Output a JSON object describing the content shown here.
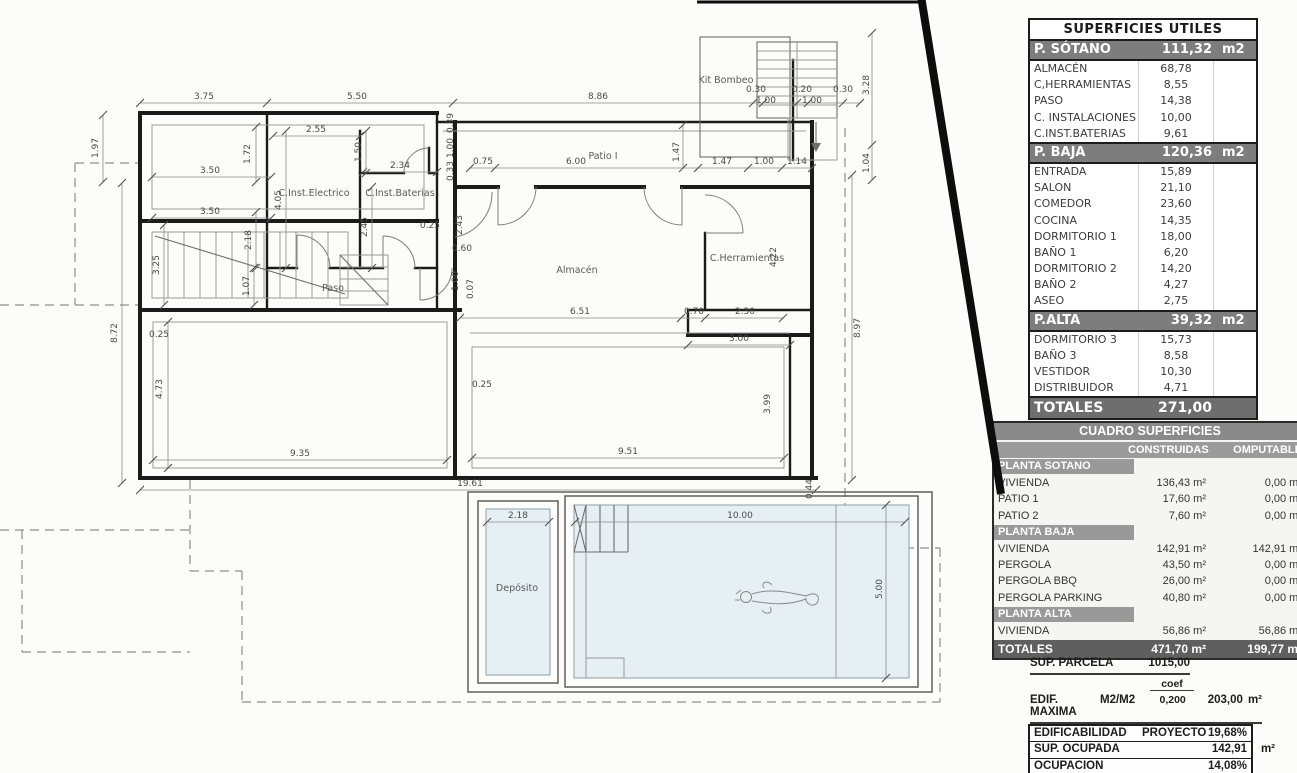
{
  "colors": {
    "table_header_gray": "#7d7d7d",
    "totals_bar_gray": "#6e6e6e",
    "dark_totals": "#5f5f5f",
    "pool_fill": "#e6eff3",
    "wall_black": "#1b1b1b"
  },
  "plan": {
    "room_labels": [
      {
        "t": "Kit Bombeo",
        "x": 726,
        "y": 83
      },
      {
        "t": "C.Inst.Electrico",
        "x": 314,
        "y": 196
      },
      {
        "t": "C.Inst.Baterias",
        "x": 400,
        "y": 196
      },
      {
        "t": "Paso",
        "x": 333,
        "y": 291
      },
      {
        "t": "Patio I",
        "x": 603,
        "y": 159
      },
      {
        "t": "Almacén",
        "x": 577,
        "y": 273
      },
      {
        "t": "C.Herramientas",
        "x": 747,
        "y": 261
      },
      {
        "t": "Depósito",
        "x": 517,
        "y": 591
      }
    ],
    "dim_labels": [
      {
        "t": "3.75",
        "x": 204,
        "y": 99
      },
      {
        "t": "5.50",
        "x": 357,
        "y": 99
      },
      {
        "t": "8.86",
        "x": 598,
        "y": 99
      },
      {
        "t": "0.30",
        "x": 756,
        "y": 92
      },
      {
        "t": "1.00",
        "x": 766,
        "y": 103
      },
      {
        "t": "0.20",
        "x": 802,
        "y": 92
      },
      {
        "t": "1.00",
        "x": 812,
        "y": 103
      },
      {
        "t": "0.30",
        "x": 843,
        "y": 92
      },
      {
        "t": "3.28",
        "x": 869,
        "y": 85,
        "v": 1
      },
      {
        "t": "1.04",
        "x": 869,
        "y": 163,
        "v": 1
      },
      {
        "t": "1.97",
        "x": 98,
        "y": 148,
        "v": 1
      },
      {
        "t": "8.72",
        "x": 117,
        "y": 333,
        "v": 1
      },
      {
        "t": "1.72",
        "x": 250,
        "y": 154,
        "v": 1
      },
      {
        "t": "3.50",
        "x": 210,
        "y": 173
      },
      {
        "t": "2.55",
        "x": 316,
        "y": 132
      },
      {
        "t": "1.50",
        "x": 361,
        "y": 152,
        "v": 1
      },
      {
        "t": "2.34",
        "x": 400,
        "y": 168
      },
      {
        "t": "4.05",
        "x": 281,
        "y": 200,
        "v": 1
      },
      {
        "t": "2.45",
        "x": 367,
        "y": 227,
        "v": 1
      },
      {
        "t": "3.50",
        "x": 210,
        "y": 214
      },
      {
        "t": "3.25",
        "x": 159,
        "y": 265,
        "v": 1
      },
      {
        "t": "2.18",
        "x": 251,
        "y": 240,
        "v": 1
      },
      {
        "t": "0.25",
        "x": 430,
        "y": 228
      },
      {
        "t": "0.39",
        "x": 453,
        "y": 123,
        "v": 1
      },
      {
        "t": "1.00",
        "x": 453,
        "y": 148,
        "v": 1
      },
      {
        "t": "0.33",
        "x": 453,
        "y": 171,
        "v": 1
      },
      {
        "t": "2.43",
        "x": 462,
        "y": 225,
        "v": 1
      },
      {
        "t": "0.60",
        "x": 462,
        "y": 251
      },
      {
        "t": "1.07",
        "x": 249,
        "y": 286,
        "v": 1
      },
      {
        "t": "1.00",
        "x": 458,
        "y": 281,
        "v": 1
      },
      {
        "t": "0.07",
        "x": 473,
        "y": 289,
        "v": 1
      },
      {
        "t": "0.75",
        "x": 483,
        "y": 164
      },
      {
        "t": "6.00",
        "x": 576,
        "y": 164
      },
      {
        "t": "1.47",
        "x": 679,
        "y": 152,
        "v": 1
      },
      {
        "t": "1.47",
        "x": 722,
        "y": 164
      },
      {
        "t": "1.00",
        "x": 764,
        "y": 164
      },
      {
        "t": "1.14",
        "x": 797,
        "y": 164
      },
      {
        "t": "4.22",
        "x": 776,
        "y": 257,
        "v": 1
      },
      {
        "t": "6.51",
        "x": 580,
        "y": 314
      },
      {
        "t": "0.70",
        "x": 694,
        "y": 314
      },
      {
        "t": "2.30",
        "x": 745,
        "y": 314
      },
      {
        "t": "3.00",
        "x": 739,
        "y": 341
      },
      {
        "t": "0.25",
        "x": 159,
        "y": 337
      },
      {
        "t": "4.73",
        "x": 162,
        "y": 389,
        "v": 1
      },
      {
        "t": "9.35",
        "x": 300,
        "y": 456
      },
      {
        "t": "0.25",
        "x": 482,
        "y": 387
      },
      {
        "t": "3.99",
        "x": 770,
        "y": 404,
        "v": 1
      },
      {
        "t": "9.51",
        "x": 628,
        "y": 454
      },
      {
        "t": "19.61",
        "x": 470,
        "y": 486
      },
      {
        "t": "0.44",
        "x": 812,
        "y": 489,
        "v": 1
      },
      {
        "t": "8.97",
        "x": 860,
        "y": 328,
        "v": 1
      },
      {
        "t": "2.18",
        "x": 518,
        "y": 518
      },
      {
        "t": "10.00",
        "x": 740,
        "y": 518
      },
      {
        "t": "5.00",
        "x": 882,
        "y": 589,
        "v": 1
      }
    ]
  },
  "tables": {
    "utiles": {
      "title": "SUPERFICIES UTILES",
      "sections": [
        {
          "name": "P. SÓTANO",
          "value": "111,32",
          "unit": "m2",
          "rows": [
            [
              "ALMACÉN",
              "68,78"
            ],
            [
              "C,HERRAMIENTAS",
              "8,55"
            ],
            [
              "PASO",
              "14,38"
            ],
            [
              "C. INSTALACIONES",
              "10,00"
            ],
            [
              "C.INST.BATERIAS",
              "9,61"
            ]
          ]
        },
        {
          "name": "P. BAJA",
          "value": "120,36",
          "unit": "m2",
          "rows": [
            [
              "ENTRADA",
              "15,89"
            ],
            [
              "SALON",
              "21,10"
            ],
            [
              "COMEDOR",
              "23,60"
            ],
            [
              "COCINA",
              "14,35"
            ],
            [
              "DORMITORIO 1",
              "18,00"
            ],
            [
              "BAÑO 1",
              "6,20"
            ],
            [
              "DORMITORIO 2",
              "14,20"
            ],
            [
              "BAÑO 2",
              "4,27"
            ],
            [
              "ASEO",
              "2,75"
            ]
          ]
        },
        {
          "name": "P.ALTA",
          "value": "39,32",
          "unit": "m2",
          "rows": [
            [
              "DORMITORIO 3",
              "15,73"
            ],
            [
              "BAÑO 3",
              "8,58"
            ],
            [
              "VESTIDOR",
              "10,30"
            ],
            [
              "DISTRIBUIDOR",
              "4,71"
            ]
          ]
        }
      ],
      "total_label": "TOTALES",
      "total_value": "271,00"
    },
    "cuadro": {
      "title": "CUADRO SUPERFICIES",
      "col1": "CONSTRUIDAS",
      "col2": "OMPUTABLE",
      "sections": [
        {
          "name": "PLANTA SOTANO",
          "rows": [
            [
              "VIVIENDA",
              "136,43 m²",
              "0,00 m²"
            ],
            [
              "PATIO 1",
              "17,60 m²",
              "0,00 m²"
            ],
            [
              "PATIO 2",
              "7,60 m²",
              "0,00 m²"
            ]
          ]
        },
        {
          "name": "PLANTA BAJA",
          "rows": [
            [
              "VIVIENDA",
              "142,91 m²",
              "142,91 m²"
            ],
            [
              "PERGOLA",
              "43,50 m²",
              "0,00 m²"
            ],
            [
              "PERGOLA BBQ",
              "26,00 m²",
              "0,00 m²"
            ],
            [
              "PERGOLA PARKING",
              "40,80 m²",
              "0,00 m²"
            ]
          ]
        },
        {
          "name": "PLANTA ALTA",
          "rows": [
            [
              "VIVIENDA",
              "56,86 m²",
              "56,86 m²"
            ]
          ]
        }
      ],
      "total": [
        "TOTALES",
        "471,70 m²",
        "199,77 m²"
      ]
    }
  },
  "footer": {
    "parcela_label": "SUP. PARCELA",
    "parcela_value": "1015,00",
    "coef_label": "coef",
    "edif_label": "EDIF. MAXIMA",
    "edif_unit": "M2/M2",
    "edif_coef": "0,200",
    "edif_value": "203,00",
    "edif_m2": "m²",
    "rows": [
      {
        "label": "EDIFICABILIDAD",
        "mid": "PROYECTO",
        "value": "19,68%",
        "outside": ""
      },
      {
        "label": "SUP. OCUPADA",
        "mid": "",
        "value": "142,91",
        "outside": "m²"
      },
      {
        "label": "OCUPACION",
        "mid": "",
        "value": "14,08%",
        "outside": ""
      }
    ]
  }
}
